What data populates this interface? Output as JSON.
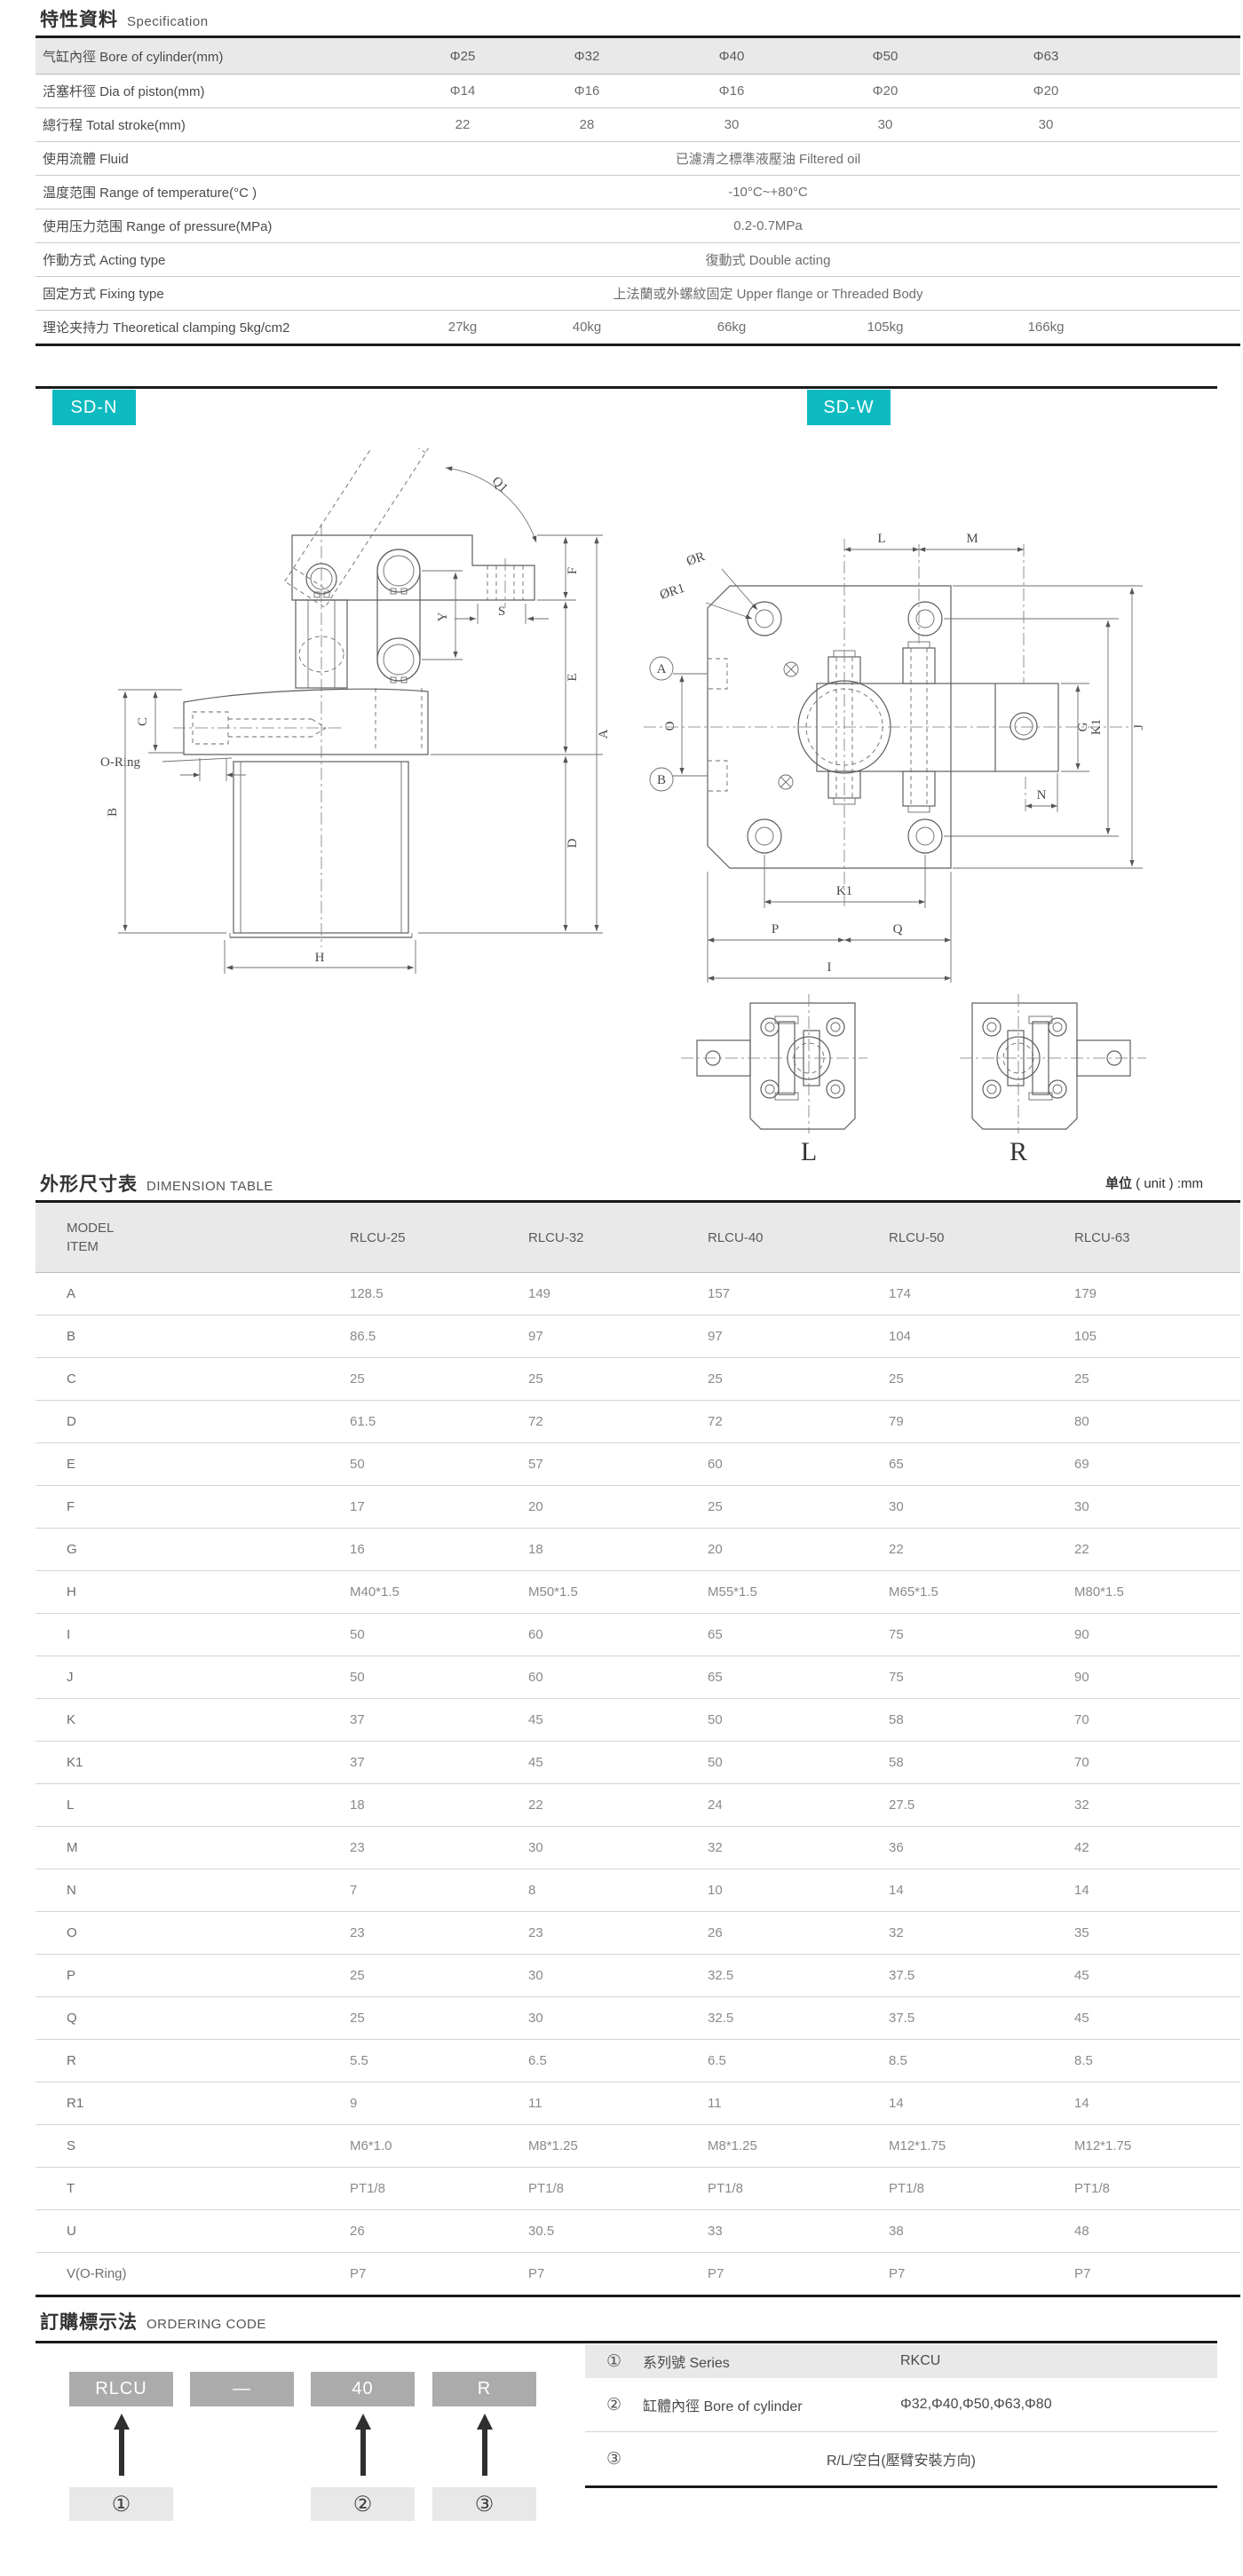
{
  "colors": {
    "accent_teal": "#0cbac0",
    "header_gray": "#e9e9e9",
    "code_box_gray": "#ababab",
    "callout_gray": "#e8e8e8",
    "thick_line": "#1a1a1a"
  },
  "spec": {
    "title_cjk": "特性資料",
    "title_en": "Specification",
    "rows": [
      {
        "label": "气缸內徑  Bore of cylinder(mm)",
        "header": true,
        "values": [
          "Φ25",
          "Φ32",
          "Φ40",
          "Φ50",
          "Φ63"
        ]
      },
      {
        "label": "活塞杆徑  Dia of piston(mm)",
        "values": [
          "Φ14",
          "Φ16",
          "Φ16",
          "Φ20",
          "Φ20"
        ]
      },
      {
        "label": "總行程  Total stroke(mm)",
        "values": [
          "22",
          "28",
          "30",
          "30",
          "30"
        ]
      },
      {
        "label": "使用流體  Fluid",
        "span": "已濾清之標準液壓油 Filtered oil"
      },
      {
        "label": "温度范围  Range of temperature(°C )",
        "span": "-10°C~+80°C"
      },
      {
        "label": "使用压力范围  Range of pressure(MPa)",
        "span": "0.2-0.7MPa"
      },
      {
        "label": "作動方式  Acting type",
        "span": "復動式 Double acting"
      },
      {
        "label": "固定方式  Fixing type",
        "span": "上法蘭或外螺紋固定 Upper  flange or Threaded Body"
      },
      {
        "label": "理论夹持力  Theoretical clamping 5kg/cm2",
        "values": [
          "27kg",
          "40kg",
          "66kg",
          "105kg",
          "166kg"
        ]
      }
    ]
  },
  "tags": {
    "left": "SD-N",
    "right": "SD-W"
  },
  "drawings": {
    "sd_n_labels": {
      "q1": "Q1",
      "f": "F",
      "s": "S",
      "y": "Y",
      "e": "E",
      "a": "A",
      "c": "C",
      "oring": "O-Ring",
      "b": "B",
      "d": "D",
      "h": "H"
    },
    "sd_w_labels": {
      "or": "ØR",
      "or1": "ØR1",
      "ca": "A",
      "cb": "B",
      "o": "O",
      "l": "L",
      "m": "M",
      "g": "G",
      "k1_right": "K1",
      "j": "J",
      "n": "N",
      "k1_bottom": "K1",
      "p": "P",
      "q": "Q",
      "i": "I"
    },
    "sub_labels": {
      "left": "L",
      "right": "R"
    }
  },
  "dimension_table": {
    "title_cjk": "外形尺寸表",
    "title_en": "DIMENSION TABLE",
    "unit_cjk": "单位",
    "unit_en": "( unit ) :mm",
    "header": {
      "line1": "MODEL",
      "line2": "ITEM",
      "models": [
        "RLCU-25",
        "RLCU-32",
        "RLCU-40",
        "RLCU-50",
        "RLCU-63"
      ]
    },
    "rows": [
      {
        "item": "A",
        "values": [
          "128.5",
          "149",
          "157",
          "174",
          "179"
        ]
      },
      {
        "item": "B",
        "values": [
          "86.5",
          "97",
          "97",
          "104",
          "105"
        ]
      },
      {
        "item": "C",
        "values": [
          "25",
          "25",
          "25",
          "25",
          "25"
        ]
      },
      {
        "item": "D",
        "values": [
          "61.5",
          "72",
          "72",
          "79",
          "80"
        ]
      },
      {
        "item": "E",
        "values": [
          "50",
          "57",
          "60",
          "65",
          "69"
        ]
      },
      {
        "item": "F",
        "values": [
          "17",
          "20",
          "25",
          "30",
          "30"
        ]
      },
      {
        "item": "G",
        "values": [
          "16",
          "18",
          "20",
          "22",
          "22"
        ]
      },
      {
        "item": "H",
        "values": [
          "M40*1.5",
          "M50*1.5",
          "M55*1.5",
          "M65*1.5",
          "M80*1.5"
        ]
      },
      {
        "item": "I",
        "values": [
          "50",
          "60",
          "65",
          "75",
          "90"
        ]
      },
      {
        "item": "J",
        "values": [
          "50",
          "60",
          "65",
          "75",
          "90"
        ]
      },
      {
        "item": "K",
        "values": [
          "37",
          "45",
          "50",
          "58",
          "70"
        ]
      },
      {
        "item": "K1",
        "values": [
          "37",
          "45",
          "50",
          "58",
          "70"
        ]
      },
      {
        "item": "L",
        "values": [
          "18",
          "22",
          "24",
          "27.5",
          "32"
        ]
      },
      {
        "item": "M",
        "values": [
          "23",
          "30",
          "32",
          "36",
          "42"
        ]
      },
      {
        "item": "N",
        "values": [
          "7",
          "8",
          "10",
          "14",
          "14"
        ]
      },
      {
        "item": "O",
        "values": [
          "23",
          "23",
          "26",
          "32",
          "35"
        ]
      },
      {
        "item": "P",
        "values": [
          "25",
          "30",
          "32.5",
          "37.5",
          "45"
        ]
      },
      {
        "item": "Q",
        "values": [
          "25",
          "30",
          "32.5",
          "37.5",
          "45"
        ]
      },
      {
        "item": "R",
        "values": [
          "5.5",
          "6.5",
          "6.5",
          "8.5",
          "8.5"
        ]
      },
      {
        "item": "R1",
        "values": [
          "9",
          "11",
          "11",
          "14",
          "14"
        ]
      },
      {
        "item": "S",
        "values": [
          "M6*1.0",
          "M8*1.25",
          "M8*1.25",
          "M12*1.75",
          "M12*1.75"
        ]
      },
      {
        "item": "T",
        "values": [
          "PT1/8",
          "PT1/8",
          "PT1/8",
          "PT1/8",
          "PT1/8"
        ]
      },
      {
        "item": "U",
        "values": [
          "26",
          "30.5",
          "33",
          "38",
          "48"
        ]
      },
      {
        "item": "V(O-Ring)",
        "values": [
          "P7",
          "P7",
          "P7",
          "P7",
          "P7"
        ]
      }
    ]
  },
  "ordering": {
    "title_cjk": "訂購標示法",
    "title_en": "ORDERING CODE",
    "code_parts": [
      "RLCU",
      "—",
      "40",
      "R"
    ],
    "callouts": [
      "①",
      "②",
      "③"
    ],
    "table": [
      {
        "no": "①",
        "label": "系列號 Series",
        "value": "RKCU"
      },
      {
        "no": "②",
        "label": "缸體內徑 Bore of cylinder",
        "value": "Φ32,Φ40,Φ50,Φ63,Φ80"
      },
      {
        "no": "③",
        "label": "",
        "value": "R/L/空白(壓臂安裝方向)"
      }
    ]
  }
}
